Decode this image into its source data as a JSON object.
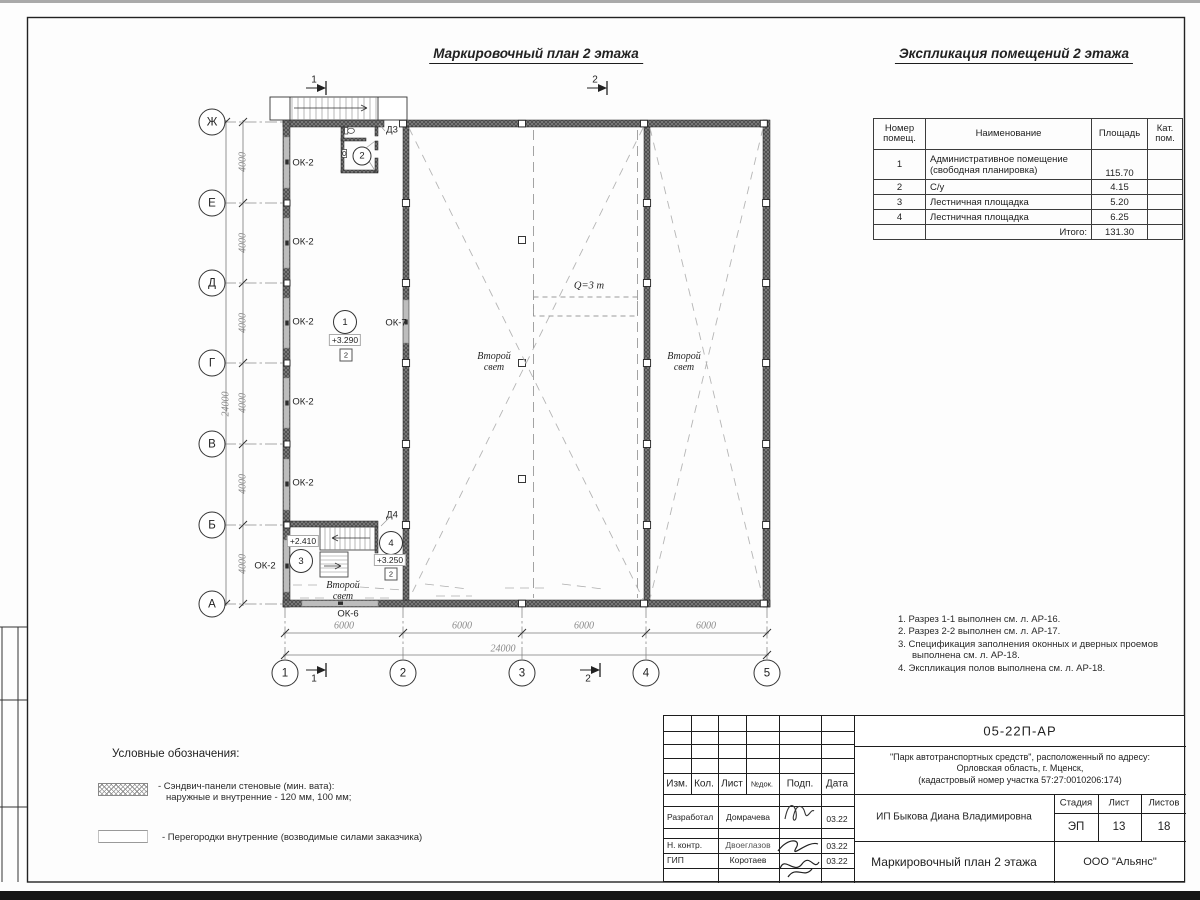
{
  "titles": {
    "plan": "Маркировочный план 2 этажа",
    "explication": "Экспликация помещений 2 этажа"
  },
  "explication_table": {
    "headers": {
      "num": "Номер\nпомещ.",
      "name": "Наименование",
      "area": "Площадь",
      "cat": "Кат.\nпом."
    },
    "rows": [
      {
        "num": "1",
        "name": "Административное помещение\n(свободная планировка)",
        "area": "115.70",
        "cat": "",
        "tall": true
      },
      {
        "num": "2",
        "name": "С/у",
        "area": "4.15",
        "cat": ""
      },
      {
        "num": "3",
        "name": "Лестничная площадка",
        "area": "5.20",
        "cat": ""
      },
      {
        "num": "4",
        "name": "Лестничная площадка",
        "area": "6.25",
        "cat": ""
      }
    ],
    "total_label": "Итого:",
    "total_value": "131.30"
  },
  "notes": [
    "Разрез 1-1 выполнен см. л. АР-16.",
    "Разрез 2-2 выполнен см. л. АР-17.",
    "Спецификация заполнения оконных и дверных проемов выполнена см. л. АР-18.",
    "Экспликация полов выполнена см. л. АР-18."
  ],
  "legend": {
    "heading": "Условные обозначения:",
    "items": [
      {
        "name": "sandwich-panels",
        "line1": "- Сэндвич-панели стеновые (мин. вата):",
        "line2": "наружные и внутренние - 120 мм, 100 мм;"
      },
      {
        "name": "partitions",
        "line1": "- Перегородки внутренние (возводимые силами заказчика)",
        "line2": ""
      }
    ]
  },
  "plan": {
    "axes_letters": [
      {
        "label": "Ж",
        "y": 122
      },
      {
        "label": "Е",
        "y": 203
      },
      {
        "label": "Д",
        "y": 283
      },
      {
        "label": "Г",
        "y": 363
      },
      {
        "label": "В",
        "y": 444
      },
      {
        "label": "Б",
        "y": 525
      },
      {
        "label": "А",
        "y": 604
      }
    ],
    "axes_numbers": [
      {
        "label": "1",
        "x": 285
      },
      {
        "label": "2",
        "x": 403
      },
      {
        "label": "3",
        "x": 522
      },
      {
        "label": "4",
        "x": 646
      },
      {
        "label": "5",
        "x": 767
      }
    ],
    "labels": [
      {
        "n": "window-label-ok2-1",
        "c": "",
        "x": 303,
        "y": 163,
        "t": "ОК-2"
      },
      {
        "n": "window-label-ok2-2",
        "c": "",
        "x": 303,
        "y": 242,
        "t": "ОК-2"
      },
      {
        "n": "window-label-ok2-3",
        "c": "",
        "x": 303,
        "y": 322,
        "t": "ОК-2"
      },
      {
        "n": "window-label-ok2-4",
        "c": "",
        "x": 303,
        "y": 402,
        "t": "ОК-2"
      },
      {
        "n": "window-label-ok2-5",
        "c": "",
        "x": 303,
        "y": 483,
        "t": "ОК-2"
      },
      {
        "n": "window-label-ok2-6",
        "c": "",
        "x": 265,
        "y": 566,
        "t": "ОК-2"
      },
      {
        "n": "window-label-ok7",
        "c": "",
        "x": 396,
        "y": 323,
        "t": "ОК-7"
      },
      {
        "n": "window-label-ok6",
        "c": "",
        "x": 348,
        "y": 614,
        "t": "ОК-6"
      },
      {
        "n": "door-label-d3",
        "c": "",
        "x": 392,
        "y": 130,
        "t": "Д3"
      },
      {
        "n": "door-label-d4",
        "c": "",
        "x": 392,
        "y": 515,
        "t": "Д4"
      },
      {
        "n": "second-light-label-1",
        "c": "ital",
        "x": 494,
        "y": 362,
        "t": "Второй\nсвет"
      },
      {
        "n": "second-light-label-2",
        "c": "ital",
        "x": 684,
        "y": 362,
        "t": "Второй\nсвет"
      },
      {
        "n": "second-light-label-3",
        "c": "ital",
        "x": 343,
        "y": 591,
        "t": "Второй\nсвет"
      },
      {
        "n": "crane-capacity-label",
        "c": "crane",
        "x": 589,
        "y": 286,
        "t": "Q=3 т"
      },
      {
        "n": "section-mark-1-top",
        "c": "sec",
        "x": 314,
        "y": 80,
        "t": "1"
      },
      {
        "n": "section-mark-2-top",
        "c": "sec",
        "x": 595,
        "y": 80,
        "t": "2"
      },
      {
        "n": "section-mark-1-bottom",
        "c": "sec",
        "x": 314,
        "y": 679,
        "t": "1"
      },
      {
        "n": "section-mark-2-bottom",
        "c": "sec",
        "x": 588,
        "y": 679,
        "t": "2"
      },
      {
        "n": "dim-4000-1",
        "c": "dim rot",
        "x": 243,
        "y": 162,
        "t": "4000"
      },
      {
        "n": "dim-4000-2",
        "c": "dim rot",
        "x": 243,
        "y": 243,
        "t": "4000"
      },
      {
        "n": "dim-4000-3",
        "c": "dim rot",
        "x": 243,
        "y": 323,
        "t": "4000"
      },
      {
        "n": "dim-4000-4",
        "c": "dim rot",
        "x": 243,
        "y": 403,
        "t": "4000"
      },
      {
        "n": "dim-4000-5",
        "c": "dim rot",
        "x": 243,
        "y": 484,
        "t": "4000"
      },
      {
        "n": "dim-4000-6",
        "c": "dim rot",
        "x": 243,
        "y": 564,
        "t": "4000"
      },
      {
        "n": "dim-24000-left",
        "c": "dim rot",
        "x": 226,
        "y": 404,
        "t": "24000"
      },
      {
        "n": "dim-6000-1",
        "c": "dim",
        "x": 344,
        "y": 626,
        "t": "6000"
      },
      {
        "n": "dim-6000-2",
        "c": "dim",
        "x": 462,
        "y": 626,
        "t": "6000"
      },
      {
        "n": "dim-6000-3",
        "c": "dim",
        "x": 584,
        "y": 626,
        "t": "6000"
      },
      {
        "n": "dim-6000-4",
        "c": "dim",
        "x": 706,
        "y": 626,
        "t": "6000"
      },
      {
        "n": "dim-24000-bottom",
        "c": "dim",
        "x": 503,
        "y": 649,
        "t": "24000"
      }
    ],
    "room_tags": [
      {
        "t": "1",
        "x": 345,
        "y": 322,
        "d": 22
      },
      {
        "t": "2",
        "x": 362,
        "y": 156,
        "d": 17
      },
      {
        "t": "3",
        "x": 301,
        "y": 561,
        "d": 22
      },
      {
        "t": "4",
        "x": 391,
        "y": 543,
        "d": 22
      }
    ],
    "level_marks": [
      {
        "t": "+3.290",
        "x": 345,
        "y": 340
      },
      {
        "t": "+2.410",
        "x": 303,
        "y": 541
      },
      {
        "t": "+3.250",
        "x": 390,
        "y": 560
      }
    ],
    "zone_marks": [
      {
        "t": "2",
        "x": 346,
        "y": 355
      },
      {
        "t": "2",
        "x": 391,
        "y": 574
      }
    ]
  },
  "title_block": {
    "doc_code": "05-22П-АР",
    "project": "\"Парк автотранспортных средств\",  расположенный по адресу:\nОрловская область, г. Мценск,\n(кадастровый номер участка 57:27:0010206:174)",
    "client": "ИП Быкова Диана Владимировна",
    "drawing_title": "Маркировочный план 2 этажа",
    "org": "ООО \"Альянс\"",
    "stage_label": "Стадия",
    "sheet_label": "Лист",
    "sheets_label": "Листов",
    "stage": "ЭП",
    "sheet": "13",
    "sheets": "18",
    "cols": {
      "izm": "Изм.",
      "kol": "Кол.",
      "list": "Лист",
      "ndok": "№док.",
      "podp": "Подп.",
      "data": "Дата"
    },
    "rows": [
      {
        "role": "Разработал",
        "name": "Домрачева",
        "date": "03.22"
      },
      {
        "role": "Н. контр.",
        "name": "Двоеглазов",
        "date": "03.22"
      },
      {
        "role": "ГИП",
        "name": "Коротаев",
        "date": "03.22"
      }
    ]
  }
}
